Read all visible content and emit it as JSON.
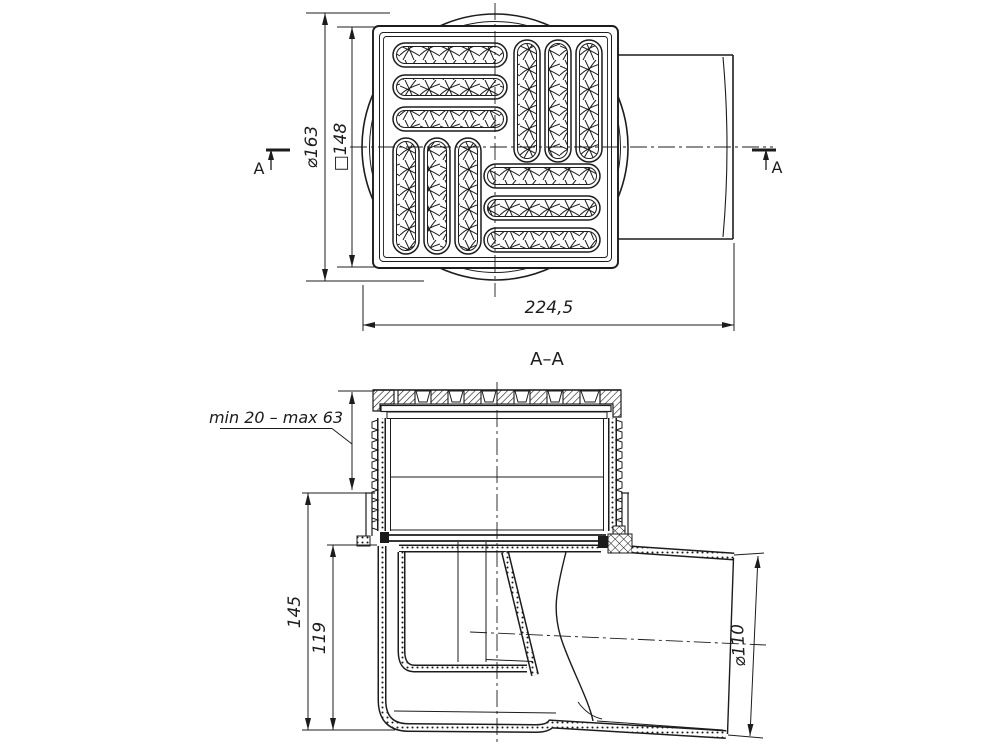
{
  "drawing": {
    "colors": {
      "line": "#1c1c1c",
      "background": "#ffffff"
    },
    "top_view": {
      "section_marker_left": "A",
      "section_marker_right": "A",
      "dims": {
        "flange_diameter": "⌀163",
        "grate_square": "□148",
        "overall_length": "224,5"
      }
    },
    "section_view": {
      "title": "A–A",
      "dims": {
        "adjustment_range": "min 20 – max 63",
        "overall_height": "145",
        "body_height": "119",
        "outlet_diameter": "⌀110"
      }
    }
  }
}
